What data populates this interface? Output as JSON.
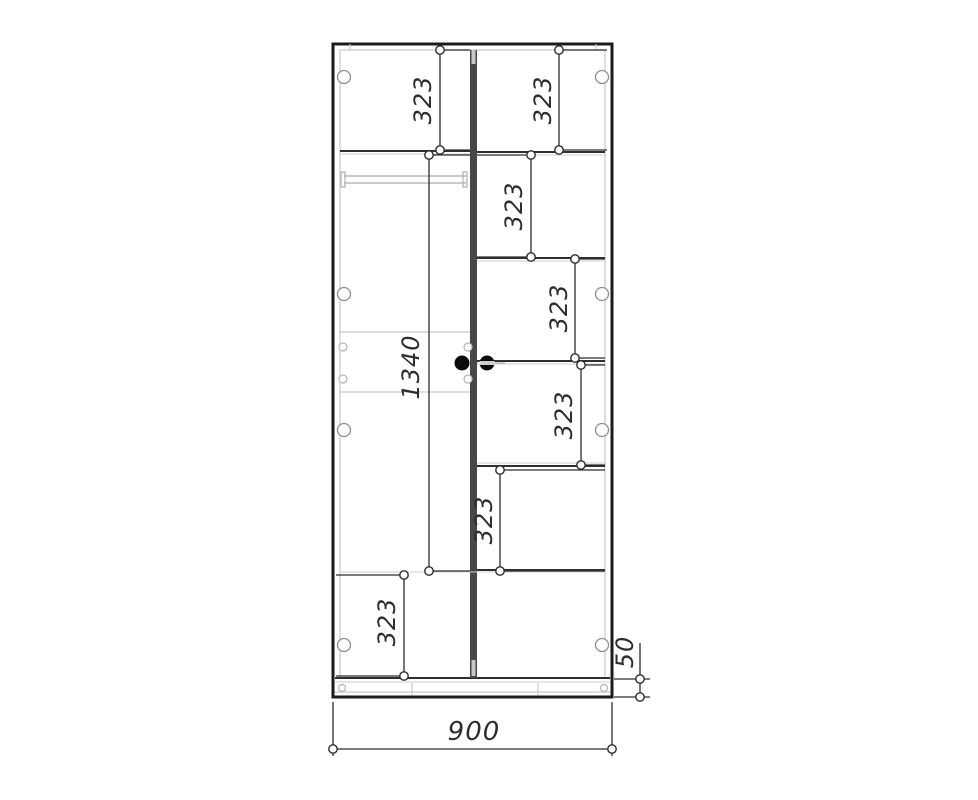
{
  "drawing": {
    "title": "wardrobe-front-elevation-drawing",
    "dimensions": {
      "left_top": "323",
      "right_top": "323",
      "right_second": "323",
      "right_third": "323",
      "right_fourth": "323",
      "right_fifth": "323",
      "left_middle": "1340",
      "left_bottom": "323",
      "plinth": "50",
      "width": "900"
    },
    "colors": {
      "background": "#ffffff",
      "outline": "#1b1b1b",
      "secondary_lines": "#c9c9c9",
      "dimension_lines": "#2d2d2d",
      "dimension_text": "#2d2d2d",
      "divider_fill": "#474747",
      "handle_fill": "#0c0c0c"
    }
  }
}
